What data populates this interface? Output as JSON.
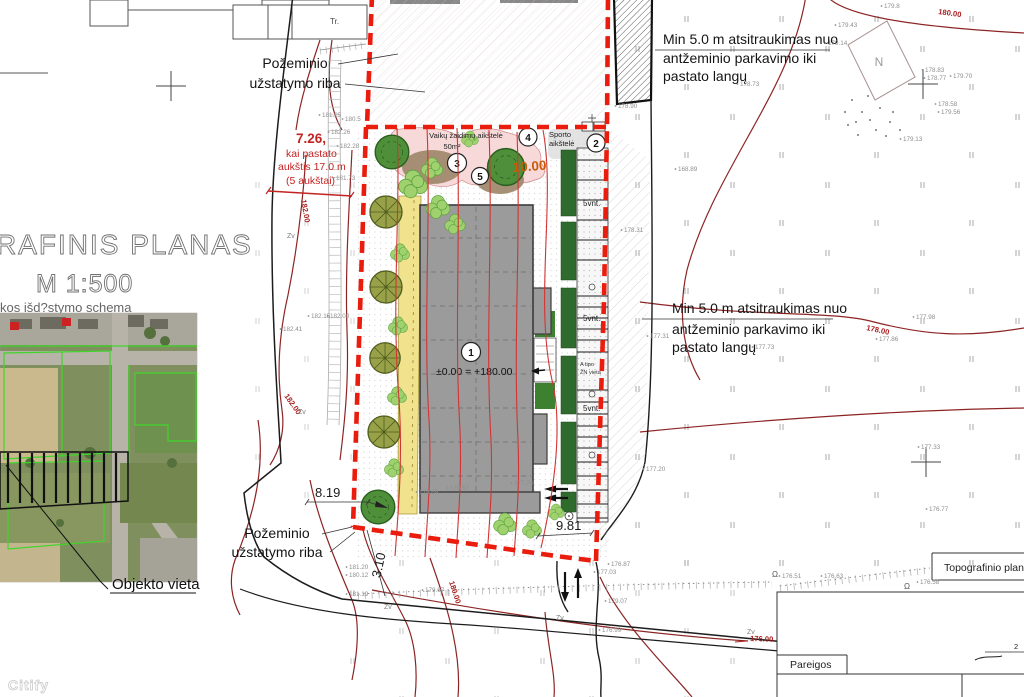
{
  "title": {
    "main": "RAFINIS PLANAS",
    "scale": "M 1:500",
    "schema_caption": "kos išd?stymo schema"
  },
  "watermark": "Citify",
  "inset": {
    "object_location": "Objekto vieta"
  },
  "labels": {
    "underground_line1": "Požeminio",
    "underground_line2": "užstatymo riba",
    "setback_line1": "Min 5.0 m atsitraukimas nuo",
    "setback_line2": "antžeminio parkavimo iki",
    "setback_line3": "pastato langų",
    "height_note_value": "7.26,",
    "height_note_line2": "kai pastato",
    "height_note_line3": "aukštis 17.0 m",
    "height_note_line4": "(5 aukštai)",
    "tr": "Tr.",
    "north": "N"
  },
  "plan": {
    "playground_label": "Vaikų žaidimų aikštelė",
    "playground_area": "50m²",
    "sport_line1": "Sporto",
    "sport_line2": "aikštelė",
    "building_level": "±0.00 = +180.00",
    "parking_label": "5vnt.",
    "disabled_line1": "A tipo",
    "disabled_line2": "ŽN vieta",
    "marker1": "1",
    "marker2": "2",
    "marker3": "3",
    "marker4": "4",
    "marker5": "5"
  },
  "dimensions": {
    "top": "10.00",
    "left": "8.19",
    "bottom": "9.81",
    "side": "3.10"
  },
  "table": {
    "header": "Topografinio plan",
    "role_label": "Pareigos",
    "page": "2"
  },
  "zv_label": "Zv",
  "contour_labels": [
    {
      "x": 938,
      "y": 14,
      "rot": 8,
      "v": "180.00"
    },
    {
      "x": 866,
      "y": 330,
      "rot": 12,
      "v": "178.00"
    },
    {
      "x": 301,
      "y": 200,
      "rot": 80,
      "v": "182.00"
    },
    {
      "x": 284,
      "y": 396,
      "rot": 55,
      "v": "182.00"
    },
    {
      "x": 449,
      "y": 582,
      "rot": 72,
      "v": "180.00"
    },
    {
      "x": 750,
      "y": 641,
      "rot": 2,
      "v": "176.00"
    }
  ],
  "spot_elevations": [
    {
      "x": 884,
      "y": 8,
      "v": "179.8"
    },
    {
      "x": 838,
      "y": 27,
      "v": "179.43"
    },
    {
      "x": 828,
      "y": 45,
      "v": "179.14"
    },
    {
      "x": 740,
      "y": 86,
      "v": "178.73"
    },
    {
      "x": 925,
      "y": 72,
      "v": "178.83"
    },
    {
      "x": 927,
      "y": 80,
      "v": "178.77"
    },
    {
      "x": 953,
      "y": 78,
      "v": "179.70"
    },
    {
      "x": 938,
      "y": 106,
      "v": "178.58"
    },
    {
      "x": 941,
      "y": 114,
      "v": "179.56"
    },
    {
      "x": 903,
      "y": 141,
      "v": "179.13"
    },
    {
      "x": 618,
      "y": 108,
      "v": "178.90"
    },
    {
      "x": 678,
      "y": 171,
      "v": "168.89"
    },
    {
      "x": 624,
      "y": 232,
      "v": "178.31"
    },
    {
      "x": 650,
      "y": 338,
      "v": "177.31"
    },
    {
      "x": 755,
      "y": 349,
      "v": "177.73"
    },
    {
      "x": 879,
      "y": 341,
      "v": "177.86"
    },
    {
      "x": 916,
      "y": 319,
      "v": "177.98"
    },
    {
      "x": 921,
      "y": 449,
      "v": "177.33"
    },
    {
      "x": 929,
      "y": 511,
      "v": "176.77"
    },
    {
      "x": 646,
      "y": 471,
      "v": "177.20"
    },
    {
      "x": 611,
      "y": 566,
      "v": "176.87"
    },
    {
      "x": 597,
      "y": 574,
      "v": "177.03"
    },
    {
      "x": 782,
      "y": 578,
      "v": "176.51"
    },
    {
      "x": 824,
      "y": 578,
      "v": "176.63"
    },
    {
      "x": 920,
      "y": 584,
      "v": "176.58"
    },
    {
      "x": 419,
      "y": 494,
      "v": "179.69"
    },
    {
      "x": 450,
      "y": 490,
      "v": "178.57"
    },
    {
      "x": 514,
      "y": 485,
      "v": "177.74"
    },
    {
      "x": 322,
      "y": 117,
      "v": "181.25"
    },
    {
      "x": 345,
      "y": 121,
      "v": "180.5"
    },
    {
      "x": 331,
      "y": 134,
      "v": "182.26"
    },
    {
      "x": 340,
      "y": 148,
      "v": "182.28"
    },
    {
      "x": 336,
      "y": 180,
      "v": "181.73"
    },
    {
      "x": 311,
      "y": 318,
      "v": "182.15"
    },
    {
      "x": 330,
      "y": 318,
      "v": "182.00"
    },
    {
      "x": 283,
      "y": 331,
      "v": "182.41"
    },
    {
      "x": 349,
      "y": 569,
      "v": "181.20"
    },
    {
      "x": 349,
      "y": 577,
      "v": "180.12"
    },
    {
      "x": 349,
      "y": 596,
      "v": "181.19"
    },
    {
      "x": 425,
      "y": 592,
      "v": "179.67"
    },
    {
      "x": 608,
      "y": 603,
      "v": "179.07"
    },
    {
      "x": 602,
      "y": 632,
      "v": "176.99"
    }
  ],
  "zv_markers": [
    {
      "x": 287,
      "y": 238
    },
    {
      "x": 298,
      "y": 414
    },
    {
      "x": 384,
      "y": 609
    },
    {
      "x": 556,
      "y": 620
    },
    {
      "x": 747,
      "y": 634
    }
  ]
}
